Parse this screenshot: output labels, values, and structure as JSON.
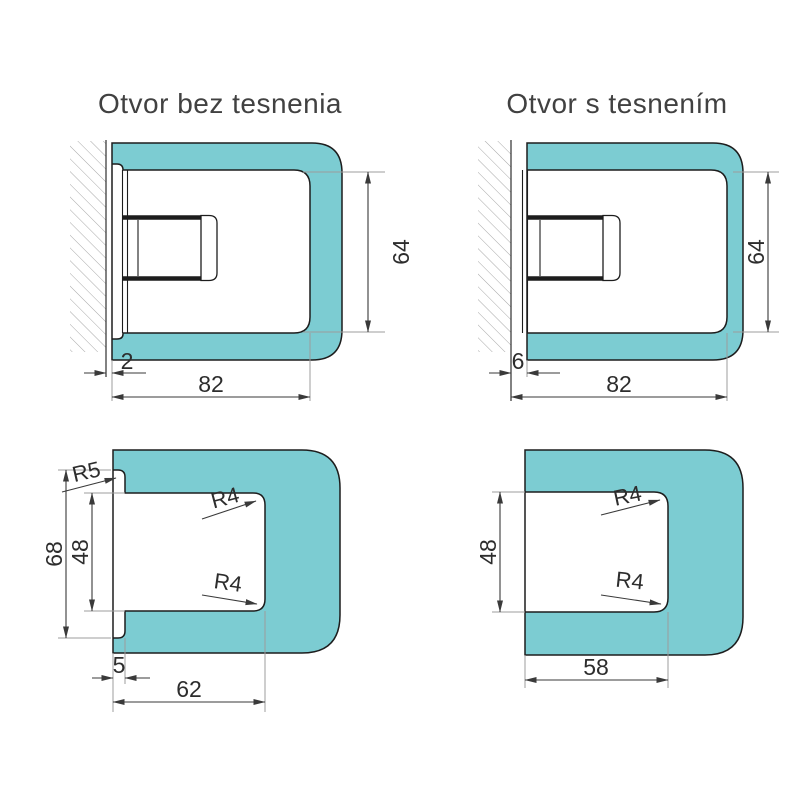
{
  "titles": {
    "top_left": "Otvor bez tesnenia",
    "top_right": "Otvor s tesnením"
  },
  "panels": {
    "top_left": {
      "gap": "2",
      "cutout_width": "82",
      "cutout_height": "64"
    },
    "top_right": {
      "gap": "6",
      "cutout_width": "82",
      "cutout_height": "64"
    },
    "bottom_left": {
      "opening_height": "68",
      "cutout_height": "48",
      "lip_depth": "5",
      "cutout_width": "62",
      "radius_outer": "R5",
      "radius_inner_top": "R4",
      "radius_inner_bottom": "R4"
    },
    "bottom_right": {
      "cutout_height": "48",
      "cutout_width": "58",
      "radius_inner_top": "R4",
      "radius_inner_bottom": "R4"
    }
  },
  "colors": {
    "glass": "#7cccd2",
    "outline": "#1d1d1d",
    "dimension": "#3a3a3a",
    "auxiliary": "#9c9c9c"
  }
}
